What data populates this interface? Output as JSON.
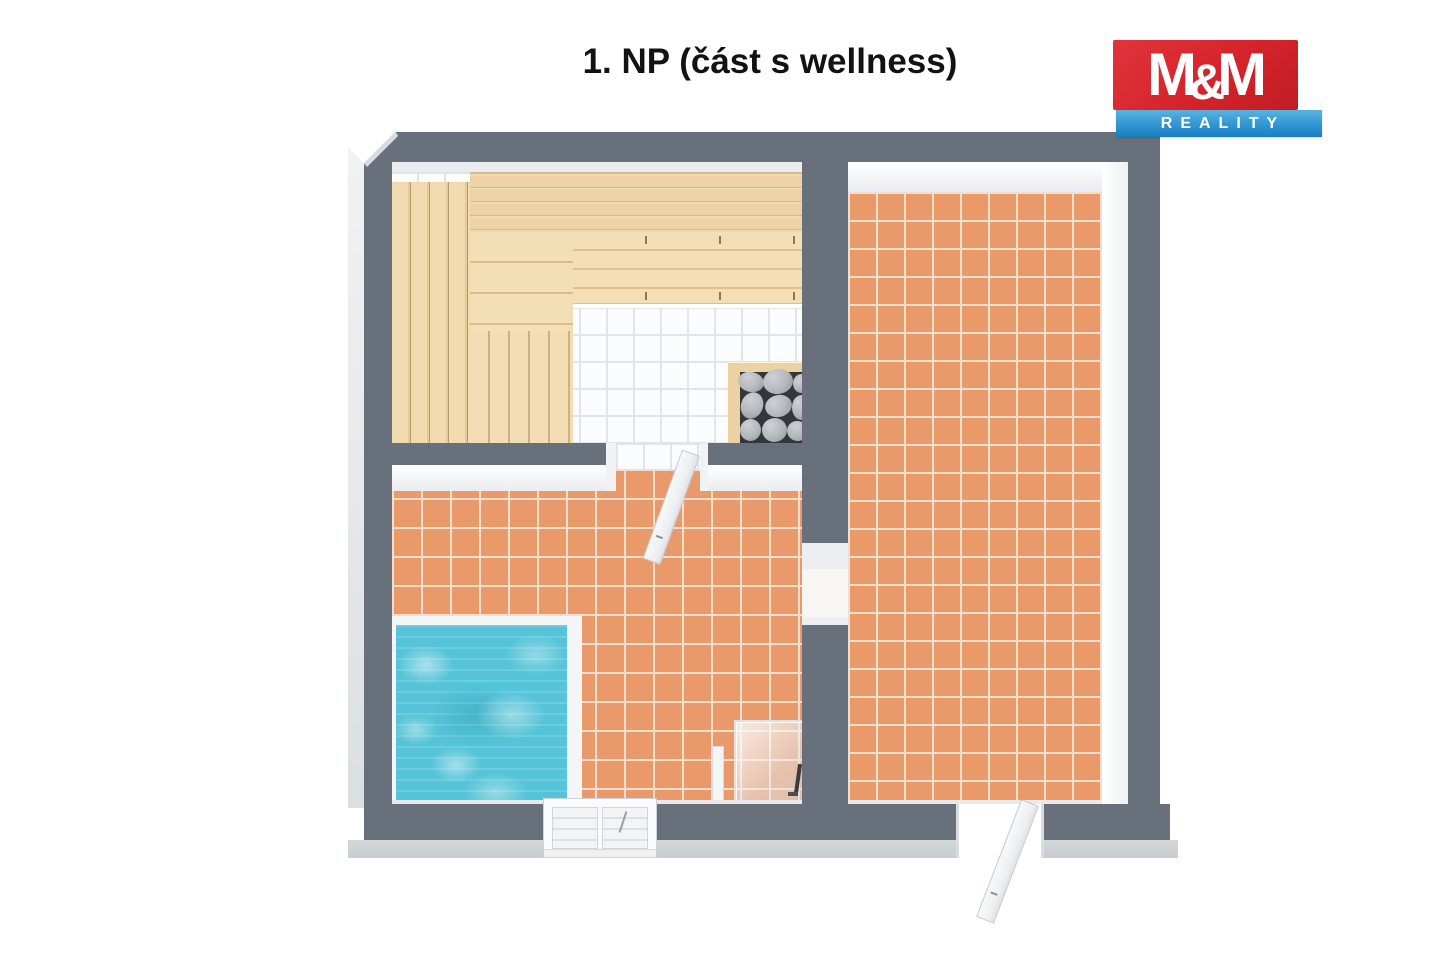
{
  "header": {
    "title": "1. NP (část s wellness)"
  },
  "logo": {
    "m_left": "M",
    "ampersand": "&",
    "m_right": "M",
    "tagline": "REALITY"
  },
  "colors": {
    "brand_red": "#d5232b",
    "brand_blue": "#2e93cf",
    "wall_gray": "#67707b",
    "tile_orange": "#e9996a",
    "grout": "#f3dfcd",
    "wood_light": "#f4deb5",
    "wood_dark": "#cfb183",
    "pool_teal": "#55c4d8",
    "sauna_tile_white": "#fbfcfd",
    "stone_gray": "#b4b8bd"
  }
}
